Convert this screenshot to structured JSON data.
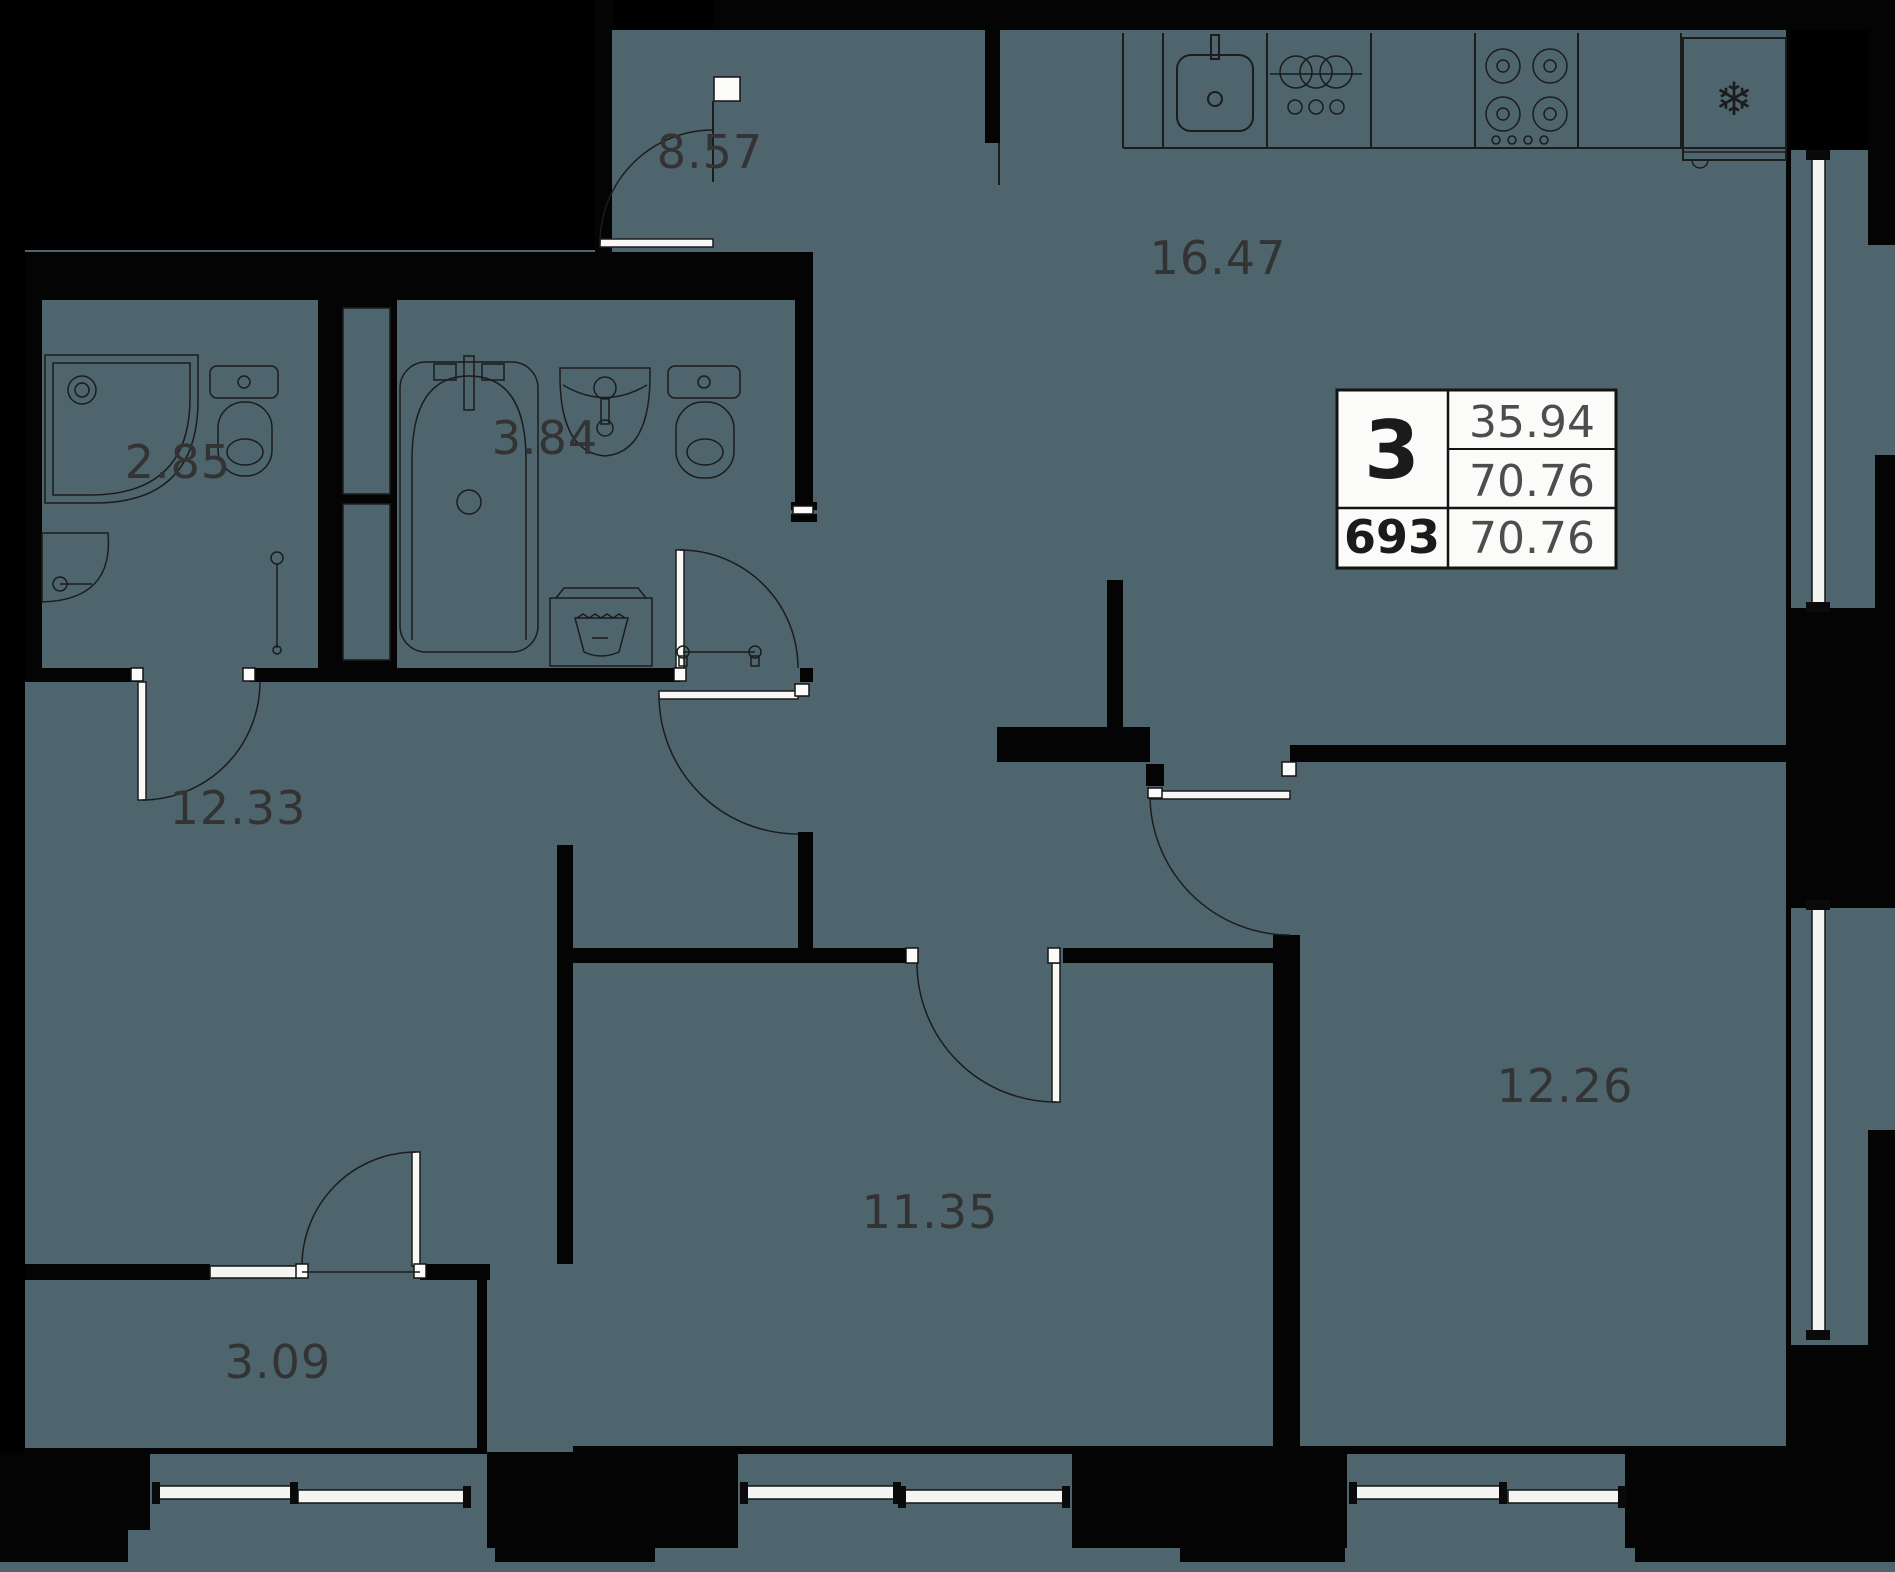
{
  "plan": {
    "title": "3-room apartment floor plan",
    "rooms": [
      {
        "id": "hallway",
        "area": "8.57"
      },
      {
        "id": "kitchen-living",
        "area": "16.47"
      },
      {
        "id": "shower-room",
        "area": "2.85"
      },
      {
        "id": "bathroom",
        "area": "3.84"
      },
      {
        "id": "bedroom-left",
        "area": "12.33"
      },
      {
        "id": "balcony",
        "area": "3.09"
      },
      {
        "id": "bedroom-middle",
        "area": "11.35"
      },
      {
        "id": "bedroom-right",
        "area": "12.26"
      }
    ],
    "info_box": {
      "rooms_count": "3",
      "area_living": "35.94",
      "area_total": "70.76",
      "unit_number": "693",
      "area_total_repeat": "70.76"
    },
    "icons": {
      "fridge_snowflake": "❄"
    },
    "colors": {
      "floor": "#4e656e",
      "walls": "#000000",
      "paper": "#fbfbf9"
    }
  }
}
